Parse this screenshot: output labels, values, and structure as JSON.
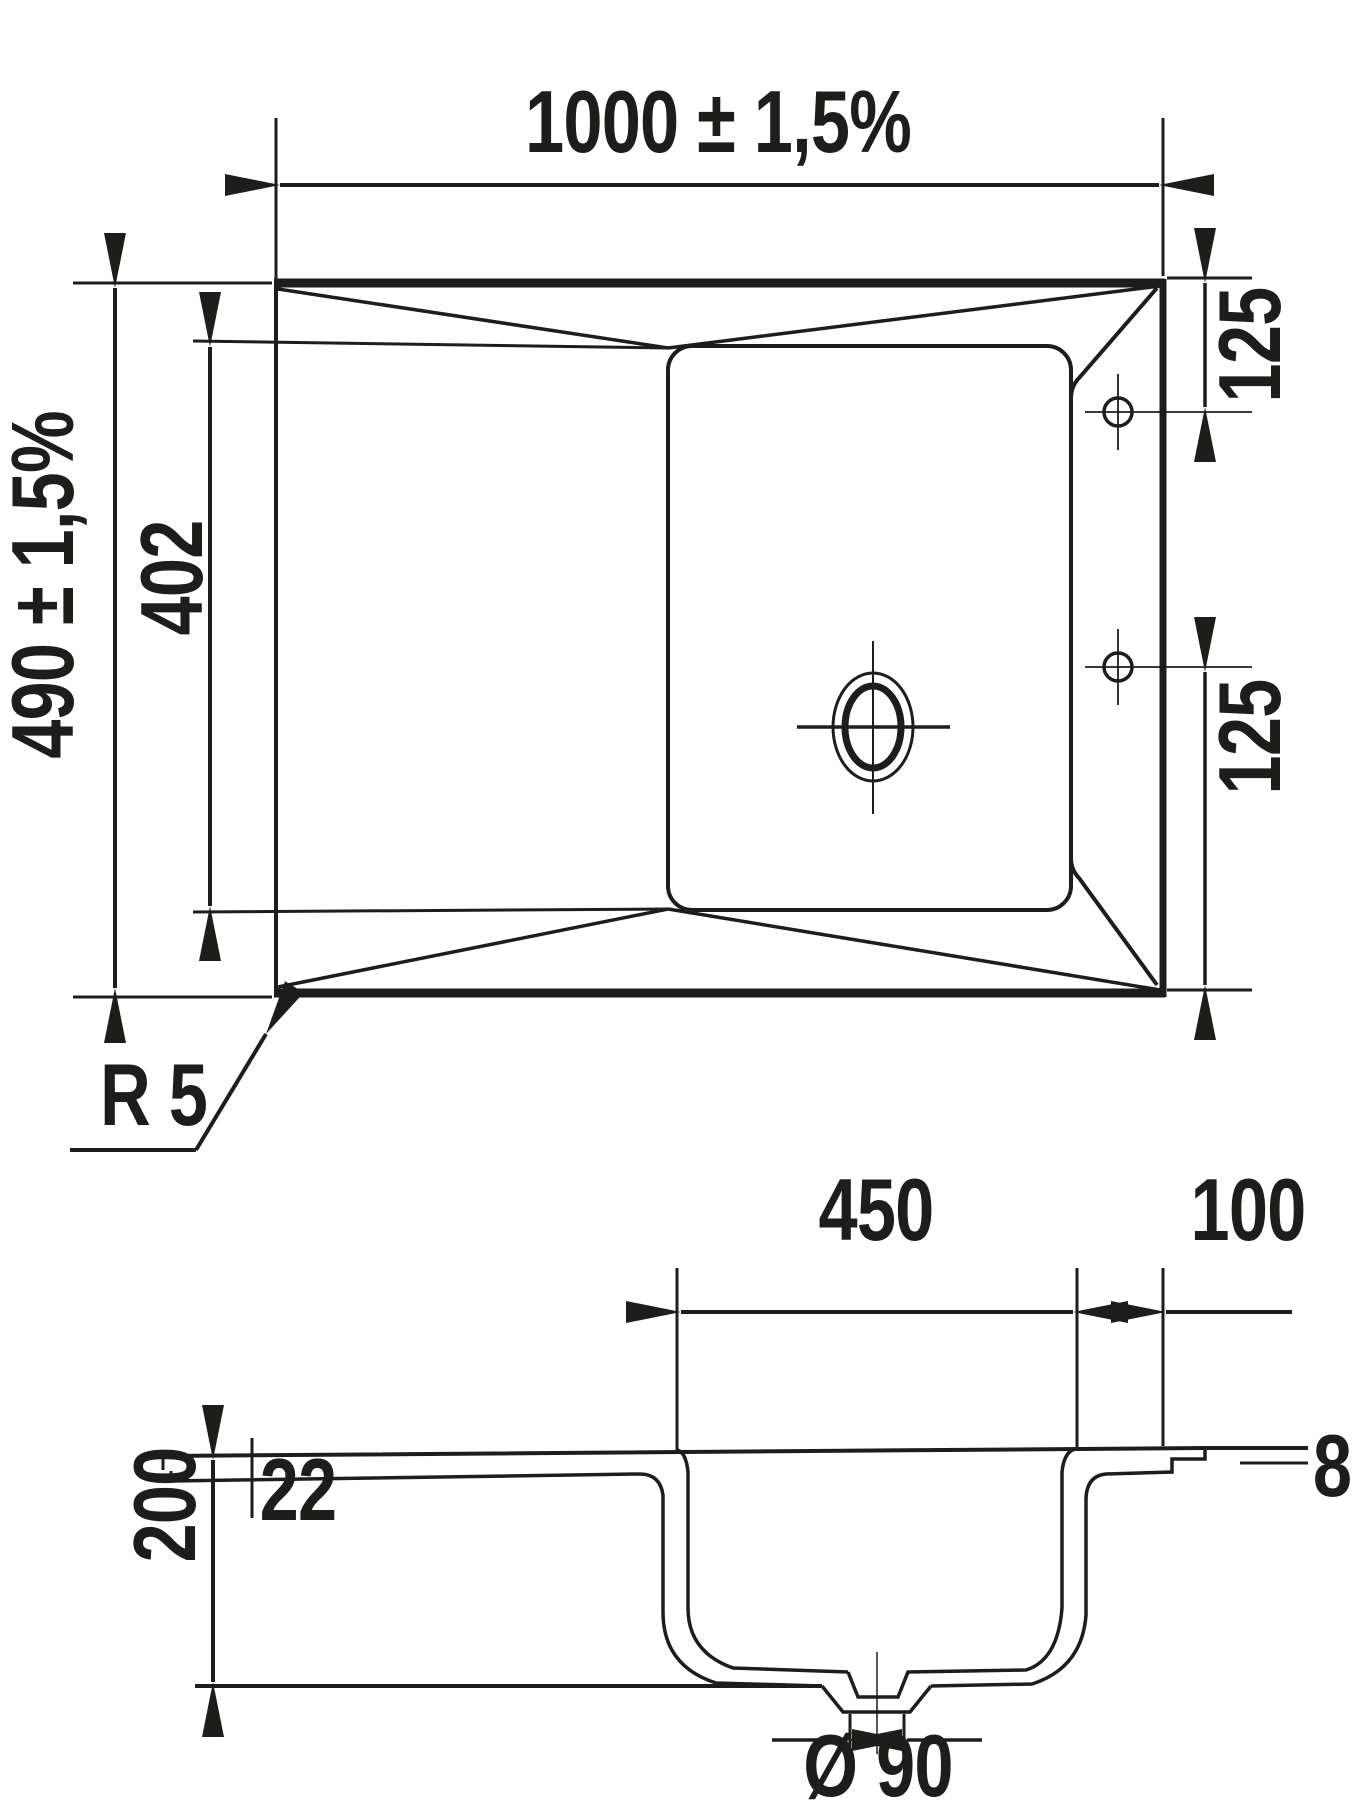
{
  "page": {
    "background": "#ffffff",
    "line_color": "#1d1d1b",
    "drawing_kind": "sink technical dimension drawing"
  },
  "top_view": {
    "overall_width": "1000 ± 1,5%",
    "overall_depth": "490 ± 1,5%",
    "drainer_length": "402",
    "tap_hole_top_offset": "125",
    "tap_hole_bottom_offset": "125",
    "corner_radius": "R 5"
  },
  "section_view": {
    "bowl_width": "450",
    "right_rim_width": "100",
    "bowl_depth": "200",
    "front_edge_height": "22",
    "rim_thickness": "8",
    "rim_thickness_tol_plus": "+ 4",
    "rim_thickness_tol_minus": "- 2",
    "drain_hole_diameter": "Ø 90"
  }
}
